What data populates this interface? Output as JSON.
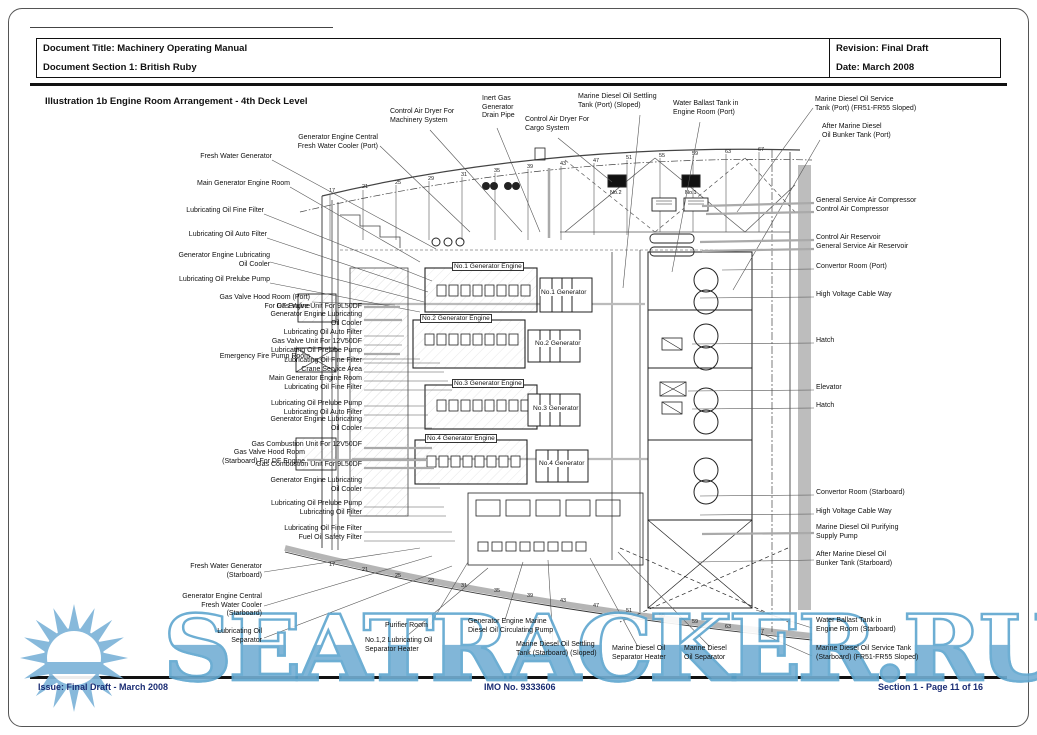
{
  "header": {
    "title": "Document Title: Machinery Operating Manual",
    "section": "Document Section 1: British Ruby",
    "revision": "Revision: Final Draft",
    "date": "Date: March 2008"
  },
  "illustration_title": "Illustration 1b Engine Room Arrangement - 4th Deck Level",
  "footer": {
    "issue": "Issue: Final Draft  -  March 2008",
    "imo": "IMO No. 9333606",
    "section_page": "Section 1  -  Page 11 of 16"
  },
  "watermark": {
    "text": "SEATRACKER.RU",
    "color": "#74afd4"
  },
  "diagram": {
    "left": [
      "Fresh Water Generator",
      "Generator Engine Central\nFresh Water Cooler (Port)",
      "Main Generator Engine Room",
      "Lubricating Oil Fine Filter",
      "Lubricating Oil Auto Filter",
      "Generator Engine Lubricating\nOil Cooler",
      "Lubricating Oil Prelube Pump",
      "Gas Valve Hood Room (Port)\nFor DF Engine",
      "Gas Valve Unit For 9L50DF",
      "Generator Engine Lubricating\nOil Cooler",
      "Lubricating Oil Auto Filter",
      "Gas Valve Unit For 12V50DF",
      "Lubricating Oil Prelube Pump",
      "Emergency Fire Pump Room",
      "Lubricating Oil Fine Filter",
      "Crane Service Area",
      "Main Generator Engine Room",
      "Lubricating Oil Fine Filter",
      "Lubricating Oil Prelube Pump",
      "Lubricating Oil Auto Filter",
      "Generator Engine Lubricating\nOil Cooler",
      "Gas Combustion Unit For 12V50DF",
      "Gas Valve Hood Room\n(Starboard) For DF Engine",
      "Gas Combustion Unit For 9L50DF",
      "Generator Engine Lubricating\nOil Cooler",
      "Lubricating Oil Prelube Pump",
      "Lubricating Oil Filter",
      "Lubricating Oil Fine Filter",
      "Fuel Oil Safety Filter",
      "Fresh Water Generator\n(Starboard)",
      "Generator Engine Central\nFresh Water Cooler\n(Starboard)",
      "Lubricating Oil\nSeparator"
    ],
    "bottom": [
      "Purifier Room",
      "No.1,2 Lubricating Oil\nSeparator Heater",
      "Generator Engine Marine\nDiesel Oil Circulating Pump",
      "Marine Diesel Oil Settling\nTank (Starboard) (Sloped)",
      "Marine Diesel Oil\nSeparator Heater",
      "Marine Diesel\nOil Separator"
    ],
    "top": [
      "Control Air Dryer For\nMachinery System",
      "Inert Gas\nGenerator\nDrain Pipe",
      "Control Air Dryer For\nCargo System",
      "Marine Diesel Oil Settling\nTank (Port) (Sloped)",
      "Water Ballast Tank in\nEngine Room (Port)",
      "Marine Diesel Oil Service\nTank (Port) (FR51-FR55 Sloped)",
      "After Marine Diesel\nOil Bunker Tank (Port)"
    ],
    "right": [
      "General Service Air Compressor",
      "Control Air Compressor",
      "Control Air Reservoir",
      "General Service Air Reservoir",
      "Convertor Room (Port)",
      "High Voltage Cable Way",
      "Hatch",
      "Elevator",
      "Hatch",
      "Convertor Room (Starboard)",
      "High Voltage Cable Way",
      "Marine Diesel Oil Purifying\nSupply Pump",
      "After Marine Diesel Oil\nBunker Tank (Starboard)",
      "Water Ballast Tank in\nEngine Room (Starboard)",
      "Marine Diesel Oil Service Tank\n(Starboard) (FR51-FR55 Sloped)"
    ],
    "engines": [
      "No.1 Generator Engine",
      "No.2 Generator Engine",
      "No.3 Generator Engine",
      "No.4 Generator Engine"
    ],
    "generators": [
      "No.1 Generator",
      "No.2 Generator",
      "No.3 Generator",
      "No.4 Generator"
    ],
    "dryers": [
      "No.2",
      "No.1"
    ],
    "frames": [
      "17",
      "21",
      "25",
      "29",
      "31",
      "35",
      "39",
      "43",
      "47",
      "51",
      "55",
      "59",
      "63",
      "67"
    ]
  }
}
